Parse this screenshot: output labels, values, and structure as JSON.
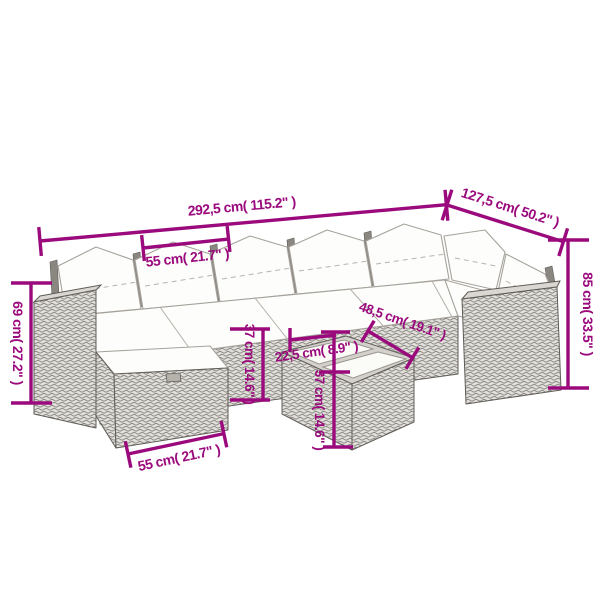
{
  "accent_color": "#9b0a7d",
  "description": "Line drawing of a poly rattan corner lounge set with white cushions, footstool and glass-top table, annotated with dimensions",
  "dims": {
    "total_width": "292,5 cm( 115.2\" )",
    "wing_depth": "127,5 cm( 50.2\" )",
    "seat_width": "55 cm( 21.7\" )",
    "arm_height": "69 cm( 27.2\" )",
    "back_height": "85 cm( 33.5\" )",
    "seat_height": "37 cm( 14.6\" )",
    "table_length": "48,5 cm( 19.1\" )",
    "table_depth": "22,5 cm( 8.9\" )",
    "table_height": "37 cm( 14.6\" )",
    "stool_width": "55 cm( 21.7\" )"
  }
}
